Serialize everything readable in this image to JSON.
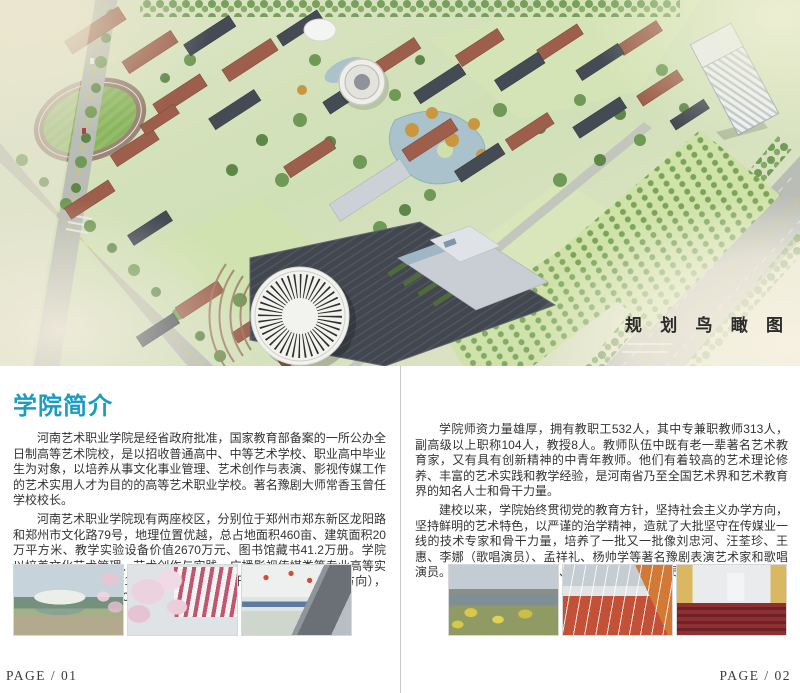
{
  "hero": {
    "caption": "规 划 鸟 瞰 图"
  },
  "left_page": {
    "heading": "学院简介",
    "paragraphs": [
      "河南艺术职业学院是经省政府批准，国家教育部备案的一所公办全日制高等艺术院校，是以招收普通高中、中等艺术学校、职业高中毕业生为对象，以培养从事文化事业管理、艺术创作与表演、影视传媒工作的艺术实用人才为目的的高等艺术职业学校。著名豫剧大师常香玉曾任学校校长。",
      "河南艺术职业学院现有两座校区，分别位于郑州市郑东新区龙阳路和郑州市文化路79号，地理位置优越，总占地面积460亩、建筑面积20万平方米、教学实验设备价值2670万元、图书馆藏书41.2万册。学院以培养文化艺术管理、艺术创作与实践、广播影视传媒类等专业高等实用人才为主，设置有11个教学系（部），开设有31个专业（含方向），现有全日制在校生4200人。"
    ],
    "page_number": "PAGE / 01"
  },
  "right_page": {
    "paragraphs": [
      "学院师资力量雄厚，拥有教职工532人，其中专兼职教师313人，副高级以上职称104人，教授8人。教师队伍中既有老一辈著名艺术教育家，又有具有创新精神的中青年教师。他们有着较高的艺术理论修养、丰富的艺术实践和教学经验，是河南省乃至全国艺术界和艺术教育界的知名人士和骨干力量。",
      "建校以来，学院始终贯彻党的教育方针，坚持社会主义办学方向，坚持鲜明的艺术特色，以严谨的治学精神，造就了大批坚守在传媒业一线的技术专家和骨干力量，培养了一批又一批像刘忠河、汪荃珍、王惠、李娜（歌唱演员）、孟祥礼、杨帅学等著名豫剧表演艺术家和歌唱演员。丁岚、张立、李光洁、蒋欣等著名影视演员也曾师读于我院。"
    ],
    "page_number": "PAGE / 02"
  },
  "colors": {
    "heading_accent": "#1b9cc4",
    "body_text": "#333333",
    "caption_text": "#2b2b2b",
    "page_divider": "#c9c9c9"
  }
}
